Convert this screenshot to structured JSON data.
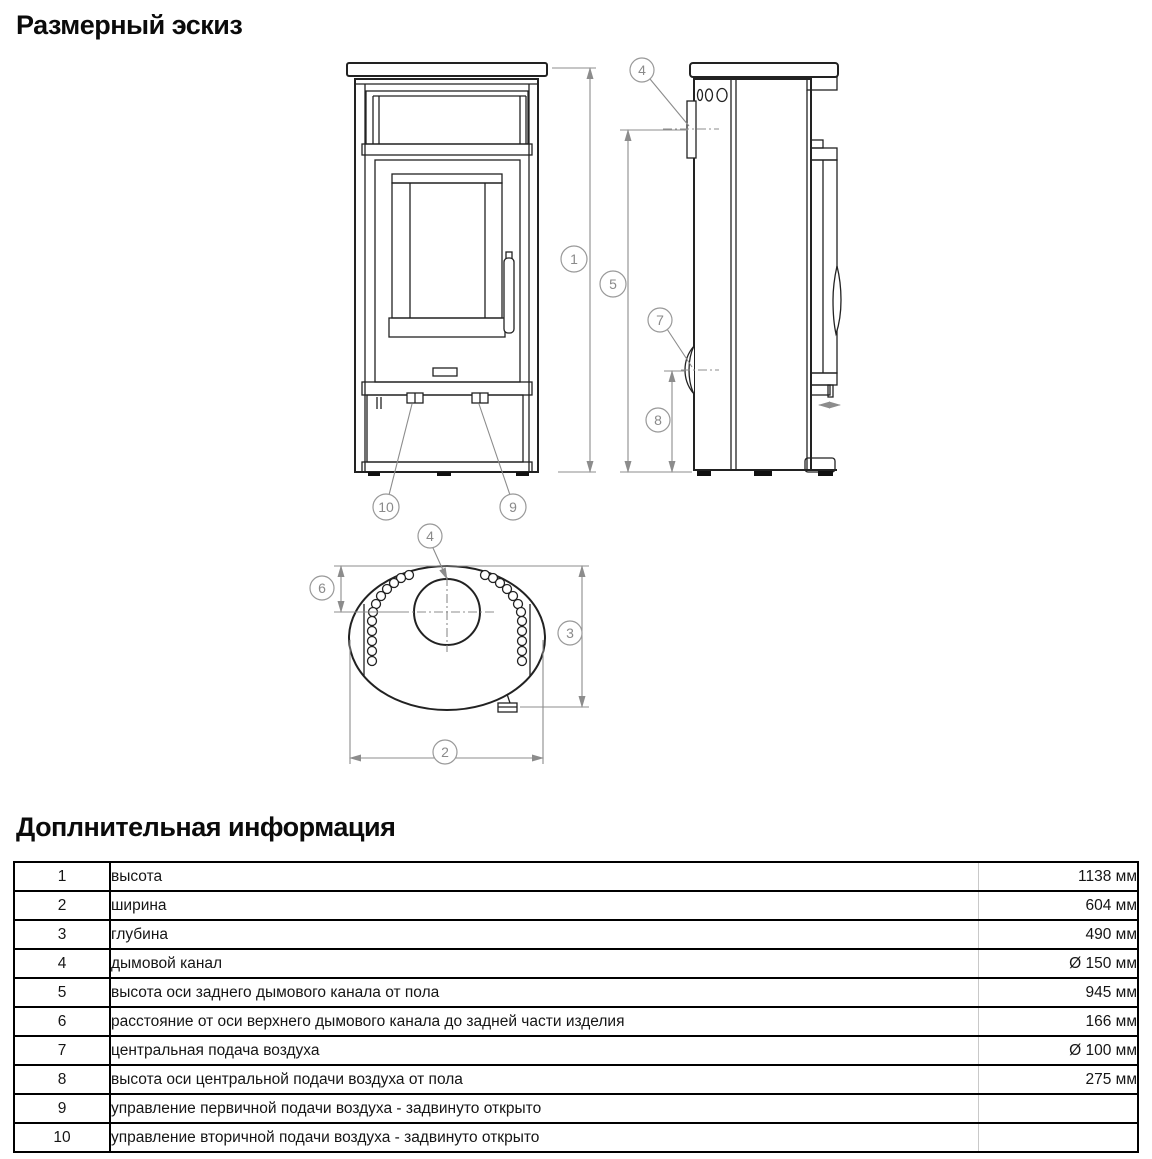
{
  "sketch": {
    "title": "Размерный эскиз",
    "callouts": [
      "1",
      "2",
      "3",
      "4",
      "5",
      "6",
      "7",
      "8",
      "9",
      "10"
    ],
    "colors": {
      "drawing_line": "#222222",
      "dimension_line": "#8c8c8c"
    }
  },
  "info": {
    "title": "Доплнительная информация",
    "rows": [
      {
        "num": "1",
        "name": "высота",
        "value": "1138 мм"
      },
      {
        "num": "2",
        "name": "ширина",
        "value": "604 мм"
      },
      {
        "num": "3",
        "name": "глубина",
        "value": "490 мм"
      },
      {
        "num": "4",
        "name": "дымовой канал",
        "value": "Ø 150 мм"
      },
      {
        "num": "5",
        "name": "высота оси заднего дымового канала от пола",
        "value": "945 мм"
      },
      {
        "num": "6",
        "name": "расстояние от оси верхнего дымового канала до задней части изделия",
        "value": "166 мм"
      },
      {
        "num": "7",
        "name": "центральная подача воздуха",
        "value": "Ø 100 мм"
      },
      {
        "num": "8",
        "name": "высота оси центральной подачи воздуха от пола",
        "value": "275 мм"
      },
      {
        "num": "9",
        "name": "управление первичной подачи воздуха - задвинуто открыто",
        "value": ""
      },
      {
        "num": "10",
        "name": "управление вторичной подачи воздуха - задвинуто открыто",
        "value": ""
      }
    ],
    "table_borders": {
      "outer": "#000000",
      "light_separator": "#c9c9c9"
    }
  }
}
